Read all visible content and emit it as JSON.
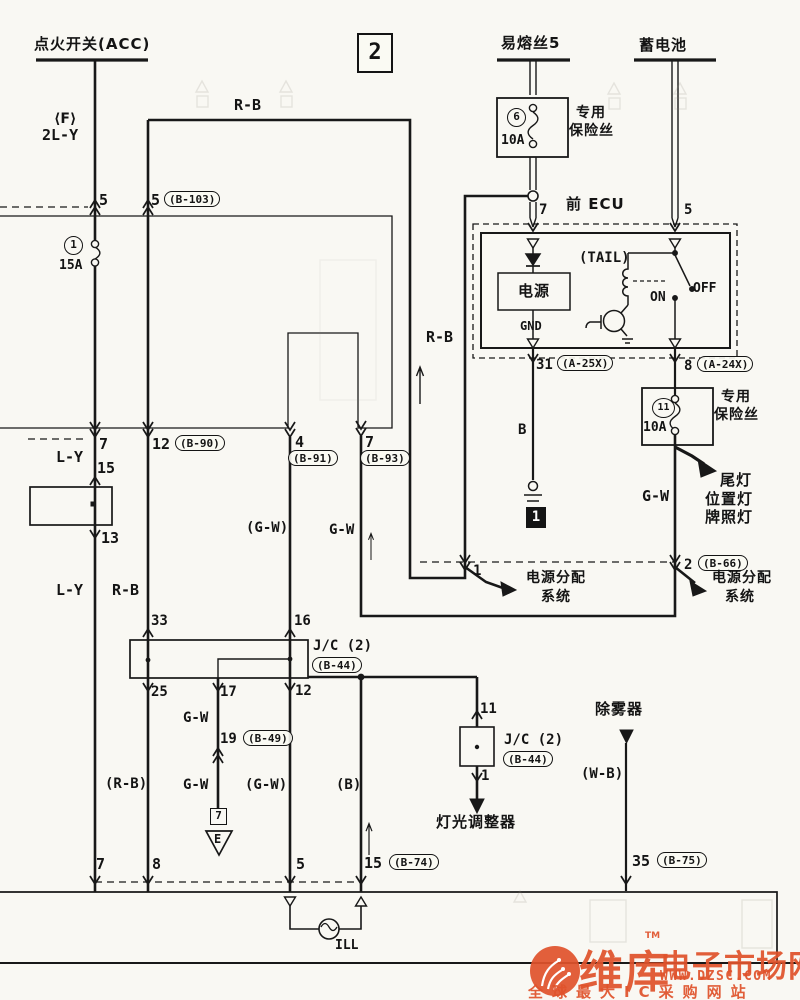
{
  "page": {
    "section_number": "2"
  },
  "sources": {
    "ignition_switch": "点火开关(ACC)",
    "ignition_connector": "⟨F⟩",
    "ignition_wire": "2L-Y",
    "fusible_link": "易熔丝5",
    "battery": "蓄电池",
    "defogger": "除雾器",
    "defogger_wire": "(W-B)"
  },
  "fuses": {
    "f1": {
      "id": "1",
      "rating": "15A"
    },
    "f6": {
      "id": "6",
      "rating": "10A",
      "note_line1": "专用",
      "note_line2": "保险丝"
    },
    "f11": {
      "id": "11",
      "rating": "10A",
      "note_line1": "专用",
      "note_line2": "保险丝"
    }
  },
  "ecu": {
    "title": "前 ECU",
    "pin7": "7",
    "pin5": "5",
    "power_box": "电源",
    "gnd": "GND",
    "tail": "(TAIL)",
    "on": "ON",
    "off": "OFF",
    "pin31": "31",
    "conn31": "(A-25X)",
    "pin8": "8",
    "conn8": "(A-24X)",
    "wire_b": "B",
    "ground_id": "1"
  },
  "wire_labels": {
    "rb_top": "R-B",
    "rb_mid": "R-B",
    "rb_left": "R-B",
    "rb_paren": "(R-B)",
    "ly_upper": "L-Y",
    "ly_lower": "L-Y",
    "gw_upper_paren": "(G-W)",
    "gw_upper": "G-W",
    "gw_branch_upper": "G-W",
    "gw_branch_lower": "G-W",
    "gw_lower_paren": "(G-W)",
    "b_paren": "(B)",
    "gw_right": "G-W"
  },
  "connectors": {
    "pin5_acc": "5",
    "pin5_b103": "5",
    "b103": "(B-103)",
    "pin7_left": "7",
    "pin15": "15",
    "pin13": "13",
    "pin12_b90": "12",
    "b90": "(B-90)",
    "pin4_b91": "4",
    "b91": "(B-91)",
    "pin7_b93": "7",
    "b93": "(B-93)",
    "pin19_b49": "19",
    "b49": "(B-49)",
    "pin1_dist": "1",
    "pin2_b66": "2",
    "b66": "(B-66)",
    "pin7_bottom": "7",
    "pin8_bottom": "8",
    "pin5_bottom": "5",
    "pin15_b74": "15",
    "b74": "(B-74)",
    "pin35_b75": "35",
    "b75": "(B-75)"
  },
  "junction1": {
    "name": "J/C (2)",
    "code": "(B-44)",
    "pin33": "33",
    "pin16": "16",
    "pin25": "25",
    "pin17": "17",
    "pin12": "12"
  },
  "junction2": {
    "name": "J/C (2)",
    "code": "(B-44)",
    "pin11": "11",
    "pin1": "1",
    "target": "灯光调整器"
  },
  "grounds": {
    "e_box_id": "7",
    "e_mark": "E"
  },
  "destinations": {
    "dist_left_line1": "电源分配",
    "dist_left_line2": "系统",
    "dist_right_line1": "电源分配",
    "dist_right_line2": "系统",
    "tail_line1": "尾灯",
    "tail_line2": "位置灯",
    "tail_line3": "牌照灯"
  },
  "lamp": {
    "ill": "ILL"
  },
  "watermark": {
    "brand_main": "维库",
    "brand_rest": "电子市场网",
    "tm": "TM",
    "url": "WWW.DZSC.COM",
    "tagline": "全球最大IC采购网站",
    "color": "#e0532c"
  }
}
